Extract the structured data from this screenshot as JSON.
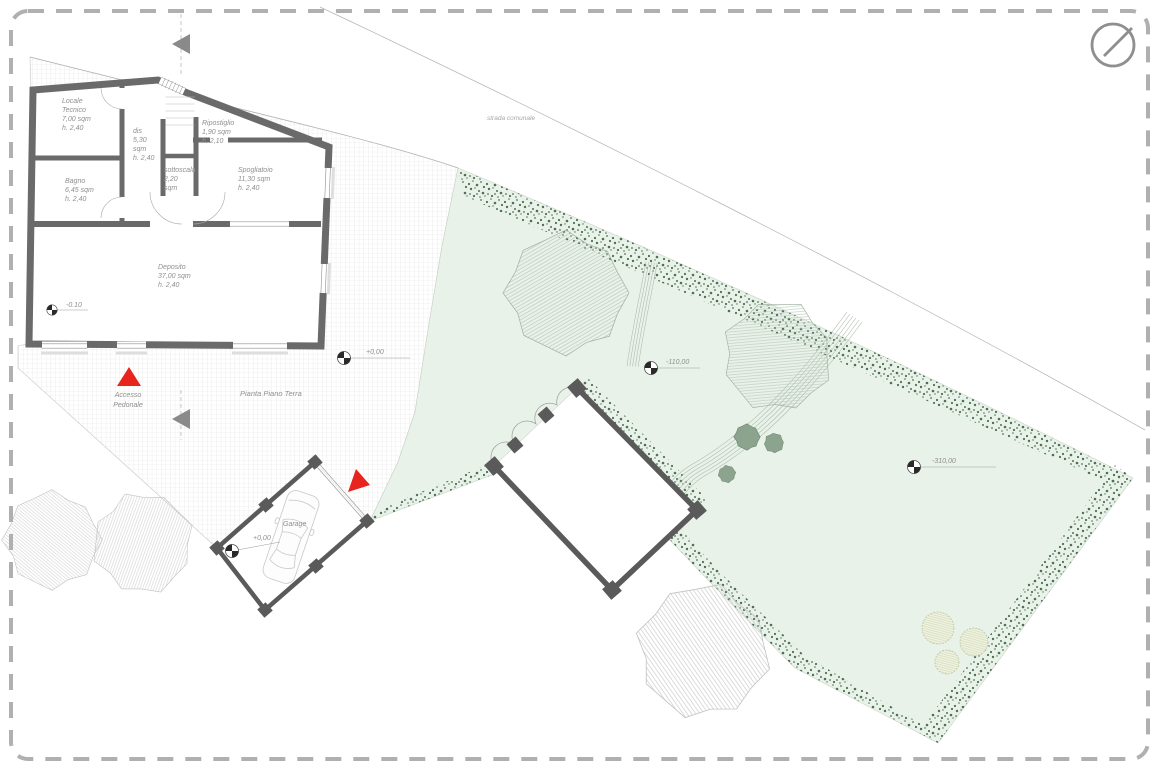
{
  "drawing": {
    "title": "Pianta Piano Terra",
    "road_label": "strada comunale",
    "access": [
      "Accesso",
      "Pedonale"
    ],
    "garage": {
      "label": "Garage",
      "level": "+0,00"
    },
    "levels": {
      "deposito": "-0.10",
      "courtyard": "+0,00",
      "garden_mid": "-110,00",
      "garden_right": "-310,00"
    },
    "rooms": {
      "locale_tecnico": {
        "lines": [
          "Locale",
          "Tecnico",
          "7,00 sqm",
          "h. 2,40"
        ]
      },
      "dis": {
        "lines": [
          "dis",
          "5,30",
          "sqm",
          "h. 2,40"
        ]
      },
      "ripostiglio": {
        "lines": [
          "Ripostiglio",
          "1,90 sqm",
          "h. 2,10"
        ]
      },
      "bagno": {
        "lines": [
          "Bagno",
          "6,45 sqm",
          "h. 2,40"
        ]
      },
      "sottoscala": {
        "lines": [
          "sottoscala",
          "2,20",
          "sqm"
        ]
      },
      "spogliatoio": {
        "lines": [
          "Spogliatoio",
          "11,30 sqm",
          "h. 2,40"
        ]
      },
      "deposito": {
        "lines": [
          "Deposito",
          "37,00 sqm",
          "h. 2,40"
        ]
      }
    },
    "colors": {
      "wall": "#6a6a6a",
      "structure": "#5a5a5a",
      "garden": "#e9f2e9",
      "hedge": "#4e7156",
      "tree_hatch_green": "#b7c6b9",
      "tree_hatch_gray": "#cdcdcd",
      "accent_red": "#e8241f",
      "label_gray": "#8f8f8f",
      "border_dash": "#b0b0b0",
      "paving_grid": "#e0e0e0"
    }
  }
}
